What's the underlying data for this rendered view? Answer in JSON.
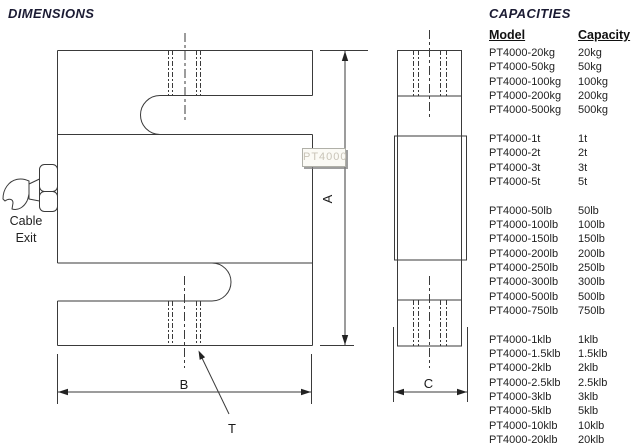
{
  "titles": {
    "dimensions": "DIMENSIONS",
    "capacities": "CAPACITIES"
  },
  "drawing": {
    "labels": {
      "dim_a": "A",
      "dim_b": "B",
      "dim_c": "C",
      "thread": "T",
      "cable_exit": "Cable\nExit"
    },
    "watermark": "PT4000"
  },
  "capacities": {
    "headers": {
      "model": "Model",
      "capacity": "Capacity"
    },
    "groups": [
      {
        "rows": [
          {
            "model": "PT4000-20kg",
            "capacity": "20kg"
          },
          {
            "model": "PT4000-50kg",
            "capacity": "50kg"
          },
          {
            "model": "PT4000-100kg",
            "capacity": "100kg"
          },
          {
            "model": "PT4000-200kg",
            "capacity": "200kg"
          },
          {
            "model": "PT4000-500kg",
            "capacity": "500kg"
          }
        ]
      },
      {
        "rows": [
          {
            "model": "PT4000-1t",
            "capacity": "1t"
          },
          {
            "model": "PT4000-2t",
            "capacity": "2t"
          },
          {
            "model": "PT4000-3t",
            "capacity": "3t"
          },
          {
            "model": "PT4000-5t",
            "capacity": "5t"
          }
        ]
      },
      {
        "rows": [
          {
            "model": "PT4000-50lb",
            "capacity": "50lb"
          },
          {
            "model": "PT4000-100lb",
            "capacity": "100lb"
          },
          {
            "model": "PT4000-150lb",
            "capacity": "150lb"
          },
          {
            "model": "PT4000-200lb",
            "capacity": "200lb"
          },
          {
            "model": "PT4000-250lb",
            "capacity": "250lb"
          },
          {
            "model": "PT4000-300lb",
            "capacity": "300lb"
          },
          {
            "model": "PT4000-500lb",
            "capacity": "500lb"
          },
          {
            "model": "PT4000-750lb",
            "capacity": "750lb"
          }
        ]
      },
      {
        "rows": [
          {
            "model": "PT4000-1klb",
            "capacity": "1klb"
          },
          {
            "model": "PT4000-1.5klb",
            "capacity": "1.5klb"
          },
          {
            "model": "PT4000-2klb",
            "capacity": "2klb"
          },
          {
            "model": "PT4000-2.5klb",
            "capacity": "2.5klb"
          },
          {
            "model": "PT4000-3klb",
            "capacity": "3klb"
          },
          {
            "model": "PT4000-5klb",
            "capacity": "5klb"
          },
          {
            "model": "PT4000-10klb",
            "capacity": "10klb"
          },
          {
            "model": "PT4000-20klb",
            "capacity": "20klb"
          }
        ]
      }
    ]
  },
  "colors": {
    "line": "#3a3a3a",
    "title_text": "#1b1b33",
    "table_text": "#222222",
    "watermark_text": "#c9c4b8"
  }
}
